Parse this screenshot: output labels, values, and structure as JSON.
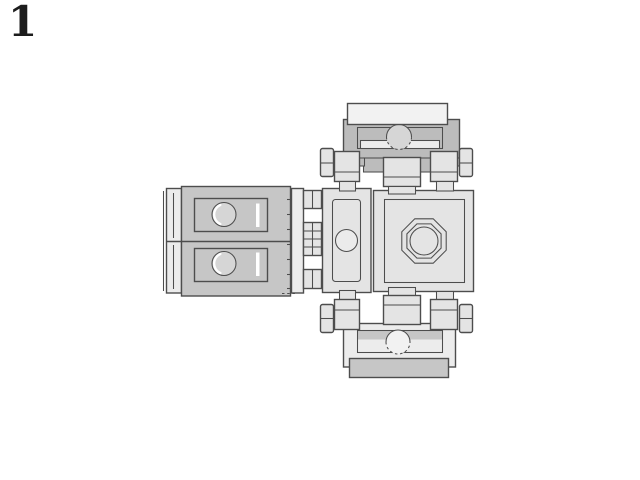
{
  "step": {
    "number": "1"
  },
  "colors": {
    "background": "#ffffff",
    "outline": "#4d4d4d",
    "surface_lightest": "#f2f2f2",
    "surface_light": "#e4e4e4",
    "surface_strip": "#ececec",
    "surface_mid": "#c6c6c6",
    "surface_dark": "#bcbcbc",
    "stud_fill": "#d6d6d6",
    "highlight": "#ffffff",
    "step_number": "#1c1c1c"
  },
  "assembly": {
    "components": [
      "left-plate-pair",
      "hinge-fingers",
      "center-plate",
      "turntable-block",
      "top-bracket",
      "bottom-bracket"
    ]
  }
}
